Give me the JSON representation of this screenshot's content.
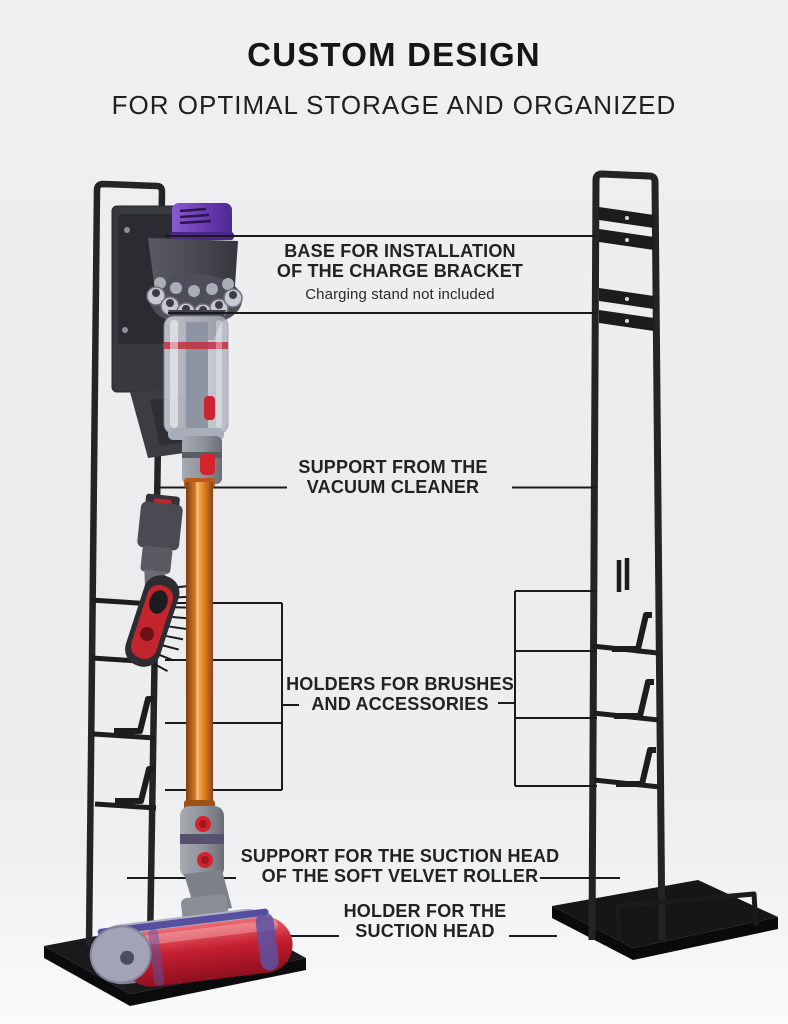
{
  "header": {
    "title": "CUSTOM DESIGN",
    "subtitle": "FOR OPTIMAL STORAGE AND ORGANIZED"
  },
  "callouts": {
    "charge_bracket": {
      "line1": "BASE FOR INSTALLATION",
      "line2": "OF THE CHARGE BRACKET",
      "note": "Charging stand not included"
    },
    "vacuum_support": {
      "line1": "SUPPORT FROM THE",
      "line2": "VACUUM CLEANER"
    },
    "holders": {
      "line1": "HOLDERS FOR BRUSHES",
      "line2": "AND ACCESSORIES"
    },
    "suction_support": {
      "line1": "SUPPORT FOR THE SUCTION HEAD",
      "line2": "OF THE SOFT VELVET ROLLER"
    },
    "suction_holder": {
      "line1": "HOLDER FOR THE",
      "line2": "SUCTION HEAD"
    }
  },
  "colors": {
    "background": "#ededef",
    "text": "#222225",
    "callout_line": "#1b1b1d",
    "stand_metal": "#232326",
    "base_plate": "#17171a",
    "wand_orange": "#d97a28",
    "cap_purple": "#6a3ab0",
    "bin_band_red": "#c22f3f",
    "roller_red": "#c41f30",
    "roller_purple": "#5a53a6",
    "accessory_red": "#c2252c",
    "metal_gray": "#8e909a"
  }
}
